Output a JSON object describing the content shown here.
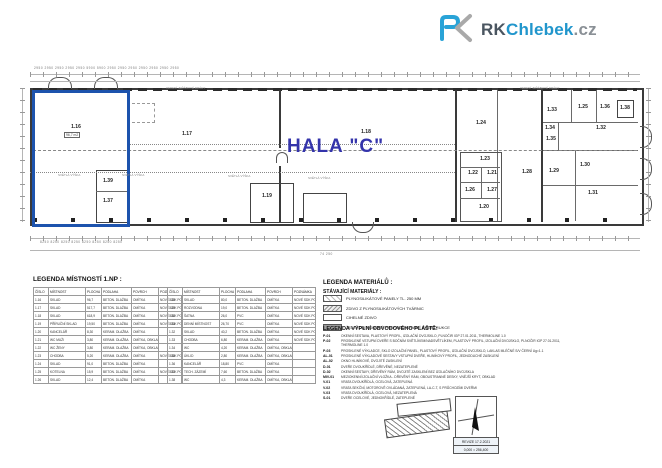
{
  "logo": {
    "rk": "RK",
    "chlebek": "Chlebek",
    "cz": ".cz",
    "blue": "#29a3d7",
    "gray": "#a9a9a9"
  },
  "plan": {
    "hall_label": "HALA \"C\"",
    "highlight_color": "#1d53ad",
    "rooms": [
      {
        "label": "1.16",
        "x": 76,
        "y": 127
      },
      {
        "label": "1.17",
        "x": 187,
        "y": 134
      },
      {
        "label": "1.18",
        "x": 366,
        "y": 132
      },
      {
        "label": "1.19",
        "x": 267,
        "y": 196
      },
      {
        "label": "1.39",
        "x": 108,
        "y": 181
      },
      {
        "label": "1.37",
        "x": 108,
        "y": 201
      },
      {
        "label": "1.24",
        "x": 481,
        "y": 123
      },
      {
        "label": "1.33",
        "x": 552,
        "y": 110
      },
      {
        "label": "1.25",
        "x": 583,
        "y": 107
      },
      {
        "label": "1.36",
        "x": 605,
        "y": 107
      },
      {
        "label": "1.38",
        "x": 625,
        "y": 108
      },
      {
        "label": "1.34",
        "x": 550,
        "y": 128
      },
      {
        "label": "1.35",
        "x": 551,
        "y": 139
      },
      {
        "label": "1.32",
        "x": 601,
        "y": 128
      },
      {
        "label": "1.23",
        "x": 485,
        "y": 159
      },
      {
        "label": "1.22",
        "x": 473,
        "y": 173
      },
      {
        "label": "1.21",
        "x": 492,
        "y": 173
      },
      {
        "label": "1.26",
        "x": 470,
        "y": 190
      },
      {
        "label": "1.27",
        "x": 492,
        "y": 190
      },
      {
        "label": "1.20",
        "x": 484,
        "y": 207
      },
      {
        "label": "1.28",
        "x": 527,
        "y": 172
      },
      {
        "label": "1.29",
        "x": 554,
        "y": 171
      },
      {
        "label": "1.30",
        "x": 585,
        "y": 165
      },
      {
        "label": "1.31",
        "x": 593,
        "y": 193
      }
    ],
    "small_notes": [
      {
        "text": "SVĚTLÁ VÝŠKA",
        "x": 58,
        "y": 173
      },
      {
        "text": "SVĚTLÁ VÝŠKA",
        "x": 122,
        "y": 173
      },
      {
        "text": "SVĚTLÁ VÝŠKA",
        "x": 228,
        "y": 174
      },
      {
        "text": "SVĚTLÁ VÝŠKA",
        "x": 308,
        "y": 176
      },
      {
        "text": "VEDENÍ JEŘÁBOVÉ DRÁHY",
        "x": 166,
        "y": 86
      },
      {
        "text": "VEDENÍ JEŘÁBOVÉ DRÁHY",
        "x": 520,
        "y": 86
      }
    ],
    "area_note_1_16": "96,7 m2"
  },
  "dimensions": {
    "top_row": "2950  2950  2950  2950  2950  5900  5900  2950  2950  2950  2950  2950  2950  2950",
    "bottom_row": "8250        8250        8250        8250        8250        8250        8250        8250",
    "total": "74 250"
  },
  "legend_rooms": {
    "title": "LEGENDA MÍSTNOSTÍ  1.NP :",
    "columns": [
      "ČÍSLO",
      "MÍSTNOST",
      "PLOCHA",
      "PODLAHA",
      "POVRCH",
      "POZNÁMKA"
    ],
    "rows_left": [
      [
        "1.16",
        "SKLAD",
        "96,7",
        "BETON. DLAŽBA",
        "OMÍTKA",
        "NOVÉ SDK PODHL."
      ],
      [
        "1.17",
        "SKLAD",
        "517,7",
        "BETON. DLAŽBA",
        "OMÍTKA",
        "NOVÉ SDK PODHL."
      ],
      [
        "1.18",
        "SKLAD",
        "618,9",
        "BETON. DLAŽBA",
        "OMÍTKA",
        "NOVÉ SDK PODHL."
      ],
      [
        "1.19",
        "PŘÍRUČNÍ SKLAD",
        "19,50",
        "BETON. DLAŽBA",
        "OMÍTKA",
        "NOVÉ SDK PODHL."
      ],
      [
        "1.20",
        "KANCELÁŘ",
        "8,30",
        "KERAM. DLAŽBA",
        "OMÍTKA",
        ""
      ],
      [
        "1.21",
        "WC MUŽI",
        "3,80",
        "KERAM. DLAŽBA",
        "OMÍTKA, OBKLAD",
        ""
      ],
      [
        "1.22",
        "WC ŽENY",
        "3,80",
        "KERAM. DLAŽBA",
        "OMÍTKA, OBKLAD",
        ""
      ],
      [
        "1.23",
        "CHODBA",
        "5,20",
        "KERAM. DLAŽBA",
        "OMÍTKA",
        "NOVÉ SDK PODHL."
      ],
      [
        "1.24",
        "SKLAD",
        "91,0",
        "BETON. DLAŽBA",
        "OMÍTKA",
        ""
      ],
      [
        "1.25",
        "KOTELNA",
        "15,9",
        "BETON. DLAŽBA",
        "OMÍTKA",
        "NOVÉ SDK PODHL."
      ],
      [
        "1.26",
        "SKLAD",
        "12,4",
        "BETON. DLAŽBA",
        "OMÍTKA",
        ""
      ]
    ],
    "rows_right": [
      [
        "1.28",
        "SKLAD",
        "80,0",
        "BETON. DLAŽBA",
        "OMÍTKA",
        "NOVÉ SDK PODHL."
      ],
      [
        "1.29",
        "ROZVODNA",
        "19,0",
        "BETON. DLAŽBA",
        "OMÍTKA",
        "NOVÉ SDK PODHL."
      ],
      [
        "1.30",
        "ŠATNA",
        "26,0",
        "PVC",
        "OMÍTKA",
        "NOVÉ SDK PODHL."
      ],
      [
        "1.31",
        "DENNÍ MÍSTNOST",
        "26,70",
        "PVC",
        "OMÍTKA",
        "NOVÉ SDK PODHL."
      ],
      [
        "1.32",
        "SKLAD",
        "40,2",
        "BETON. DLAŽBA",
        "OMÍTKA",
        "NOVÉ SDK PODHL."
      ],
      [
        "1.33",
        "CHODBA",
        "6,80",
        "KERAM. DLAŽBA",
        "OMÍTKA",
        "NOVÉ SDK PODHL."
      ],
      [
        "1.34",
        "WC",
        "4,20",
        "KERAM. DLAŽBA",
        "OMÍTKA, OBKLAD",
        ""
      ],
      [
        "1.35",
        "ÚKLID",
        "2,80",
        "KERAM. DLAŽBA",
        "OMÍTKA, OBKLAD",
        ""
      ],
      [
        "1.36",
        "KANCELÁŘ",
        "18,80",
        "PVC",
        "OMÍTKA",
        ""
      ],
      [
        "1.37",
        "TECH. ZÁZEMÍ",
        "7,60",
        "BETON. DLAŽBA",
        "OMÍTKA",
        ""
      ],
      [
        "1.38",
        "WC",
        "4,3",
        "KERAM. DLAŽBA",
        "OMÍTKA, OBKLAD",
        ""
      ]
    ]
  },
  "legend_materials": {
    "title": "LEGENDA MATERIÁLŮ :",
    "subtitle": "STÁVAJÍCÍ MATERIÁLY :",
    "items": [
      {
        "label": "PLYNOSILIKÁTOVÉ PANELY TL. 250 MM",
        "fill": "hatch-light"
      },
      {
        "label": "ZDIVO Z PLYNOSILIKÁTOVÝCH TVÁRNIC",
        "fill": "hatch-mid"
      },
      {
        "label": "CIHELNÉ ZDIVO",
        "fill": "plain"
      },
      {
        "label": "ŽELEZOBETONOVÉ PREFABRIKOVANÉ KONSTRUKCE",
        "fill": "solid-gray"
      }
    ]
  },
  "legend_fills": {
    "title": "LEGENDA VÝPLNÍ OBVODOVÉHO PLÁŠTĚ:",
    "items": [
      {
        "code": "P-01",
        "desc": "OKENNÍ SESTAVA, PLASTOVÝ PROFIL, IZOLAČNÍ DVOJSKLO, PLNOČIR IGP 27.01.2011, THERMOLINE 1.0"
      },
      {
        "code": "P-02",
        "desc": "PROSKLENÉ VSTUPNÍ DVEŘE S BOČNÍM SVĚTLÍKEM/NADSVĚTLÍKEM, PLASTOVÝ PROFIL, IZOLAČNÍ DVOJSKLO, PLNOČIR IGP 27.01.2011, THERMOLINE 1.0"
      },
      {
        "code": "P-03",
        "desc": "PROSKLENÉ VÝKLADCE, SKLO IZOLAČNÍ PANEL, PLASTOVÝ PROFIL, IZOLAČNÍ DVOJSKLO, LAKLAS MLÉČNÉ S/V ČERNÍ Ug=1.1"
      },
      {
        "code": "AL-01",
        "desc": "PROSKLENÉ VÝKLADOVÉ SESTAVY VSTUPNÍ DVEŘE, HLINÍKOVÝ PROFIL, JEDNODUCHÉ ZASKLENÍ"
      },
      {
        "code": "AL-02",
        "desc": "OKNO HLINÍKOVÉ, DVOJITÉ ZASKLENÍ"
      },
      {
        "code": "D-01",
        "desc": "DVEŘE DVOUKŘÍDLÉ, DŘEVĚNÉ, NEZATEPLENÉ"
      },
      {
        "code": "D-02",
        "desc": "OKENNÍ SESTAVY, DŘEVĚNÝ RÁM, DVOJITÉ ZASKLENÍ BEZ IZOLAČNÍHO DVOJSKLA"
      },
      {
        "code": "MIV-01",
        "desc": "MEZIOKENNÍ IZOLAČNÍ VLOŽKA - DŘEVĚNÝ RÁM, OBOUSTRANNÉ DESKY, VNĚJŠÍ KRYT, OBKLAD"
      },
      {
        "code": "V-01",
        "desc": "VRATA DVOUKŘÍDLÁ, OCELOVÁ, ZATEPLENÁ"
      },
      {
        "code": "V-02",
        "desc": "VRATA SEKČNÍ, MOTOROVĚ OVLÁDANÁ, ZATEPLENÁ, LA-C-T, S PRŮCHOZÍMI DVEŘMI"
      },
      {
        "code": "V-03",
        "desc": "VRATA DVOUKŘÍDLÁ, OCELOVÁ, NEZATEPLENÁ"
      },
      {
        "code": "S-01",
        "desc": "DVEŘE OCELOVÉ, JEDNOKŘÍDLÉ, ZATEPLENÉ"
      }
    ]
  },
  "titleblock": {
    "revision": "REVIZE  17.2.2021",
    "level": "0,000 = 256,400"
  }
}
